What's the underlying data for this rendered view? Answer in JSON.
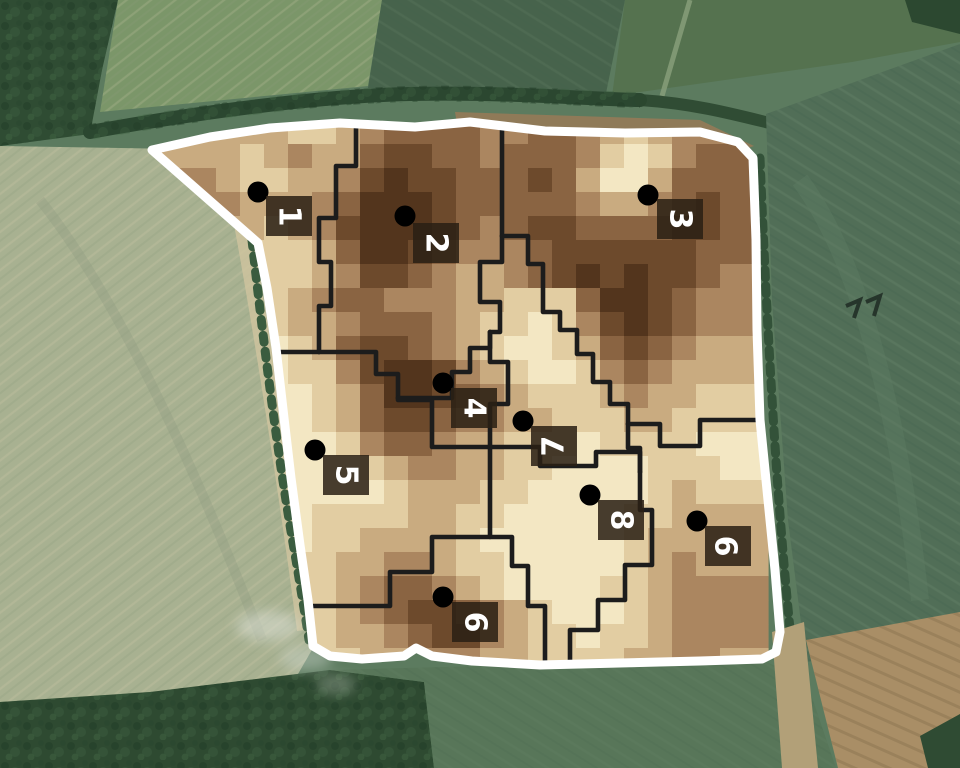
{
  "map": {
    "description": "aerial field map with 9 management zones",
    "colors": {
      "field_outline": "#ffffff",
      "zone_border": "#1c1c1c",
      "dot": "#000000",
      "label_box": "#2a2014",
      "label_box_opacity": 0.86,
      "label_text": "#ffffff"
    },
    "raster": {
      "origin_x": 144,
      "origin_y": 120,
      "cell": 24,
      "palette": [
        "#f3e7c3",
        "#e2cda2",
        "#c9ab80",
        "#ab8660",
        "#8a6442",
        "#6d4a2c",
        "#53351d"
      ],
      "rows": [
        "22222211234444334432123333",
        "22221232245544344431013444",
        "23321122356554445420024444",
        "23332223466654444432234544",
        "12222123566654345544445544",
        "22221112466543334555555444",
        "22111112355432234565655433",
        "11110123443332211146654333",
        "11000122344432110135654333",
        "11000012455432100124543222",
        "00000011356653210013432222",
        "00000001246654321112322111",
        "00000001245543322111221111",
        "00000000134432211101111000",
        "00000000012332211000011100",
        "00000000001222110000012111",
        "00000001111221100000112222",
        "00000001122221000000122222",
        "00000011223321100000123222",
        "00000011234432100001123333",
        "00000011234554321000123333",
        "00000001223455321101123333",
        "00000001122333221111223322"
      ]
    },
    "field_outline_path": "M152,150 L210,137 L270,128 L340,123 L415,127 L470,122 L545,131 L625,133 L700,132 L738,142 L753,158 L756,240 L757,330 L760,420 L768,500 L775,570 L780,632 L776,652 L762,659 L700,661 L620,663 L540,665 L472,661 L432,656 L416,648 L404,656 L362,659 L330,656 L313,646 L308,600 L300,545 L291,478 L284,418 L276,348 L267,288 L258,243 Z",
    "zone_borders": [
      "M356,114 V166 H336 V218 H319 V262 H331 V306 H319 V352",
      "M268,352 H319",
      "M319,352 H376 V374 H398 V398",
      "M398,398 H452 V372 H470 V348 H490 V332",
      "M502,114 V236",
      "M502,236 V262 H480 V302 H500 V332 H490",
      "M490,332 V362 H508 V404 H490 V447",
      "M398,398 V400 H432 V447 H490",
      "M490,447 V537 H432 V572 H390 V606 H296",
      "M502,236 H528 V264 H543 V294 V312 H560 V330 H577 V354 H593 V382 H610 V404 H628 V424",
      "M628,424 H660 V446 H700 V420 H770",
      "M628,424 V448 H640 V472",
      "M490,447 H540 V466 H596 V452 H640 V472",
      "M640,472 V510 H652 V565 H625 V600 H598 V630 H570 V668",
      "M490,537 H512 V566 H528 V606 H545 V668"
    ],
    "zones": [
      {
        "label": "1",
        "dot": {
          "x": 258,
          "y": 192
        },
        "box": {
          "x": 266,
          "y": 196,
          "w": 46,
          "h": 40
        },
        "rot": 90
      },
      {
        "label": "2",
        "dot": {
          "x": 405,
          "y": 216
        },
        "box": {
          "x": 413,
          "y": 223,
          "w": 46,
          "h": 40
        },
        "rot": 90
      },
      {
        "label": "3",
        "dot": {
          "x": 648,
          "y": 195
        },
        "box": {
          "x": 657,
          "y": 199,
          "w": 46,
          "h": 40
        },
        "rot": 90
      },
      {
        "label": "4",
        "dot": {
          "x": 443,
          "y": 383
        },
        "box": {
          "x": 451,
          "y": 388,
          "w": 46,
          "h": 40
        },
        "rot": 90
      },
      {
        "label": "5",
        "dot": {
          "x": 315,
          "y": 450
        },
        "box": {
          "x": 323,
          "y": 455,
          "w": 46,
          "h": 40
        },
        "rot": 90
      },
      {
        "label": "6",
        "dot": {
          "x": 443,
          "y": 597
        },
        "box": {
          "x": 452,
          "y": 602,
          "w": 46,
          "h": 40
        },
        "rot": 90
      },
      {
        "label": "7",
        "dot": {
          "x": 523,
          "y": 421
        },
        "box": {
          "x": 531,
          "y": 426,
          "w": 46,
          "h": 40
        },
        "rot": -90
      },
      {
        "label": "8",
        "dot": {
          "x": 590,
          "y": 495
        },
        "box": {
          "x": 598,
          "y": 500,
          "w": 46,
          "h": 40
        },
        "rot": 90
      },
      {
        "label": "9",
        "dot": {
          "x": 697,
          "y": 521
        },
        "box": {
          "x": 705,
          "y": 526,
          "w": 46,
          "h": 40
        },
        "rot": -90
      }
    ]
  }
}
